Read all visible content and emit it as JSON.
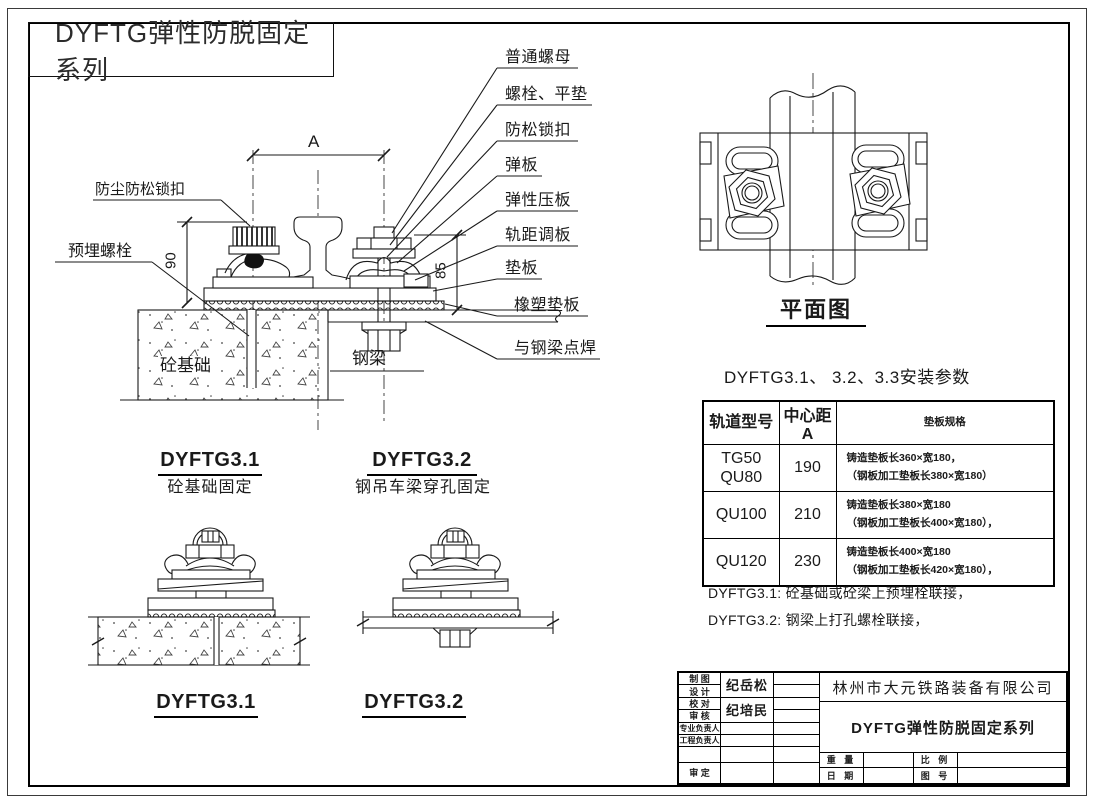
{
  "colors": {
    "ink": "#1a1a1a",
    "paper": "#ffffff"
  },
  "sheet_title": "DYFTG弹性防脱固定系列",
  "main_view": {
    "callouts": [
      "普通螺母",
      "螺栓、平垫",
      "防松锁扣",
      "弹板",
      "弹性压板",
      "轨距调板",
      "垫板",
      "橡塑垫板",
      "与钢梁点焊"
    ],
    "label_dust_lock": "防尘防松锁扣",
    "label_embed_bolt": "预埋螺栓",
    "label_concrete": "砼基础",
    "label_steel_beam": "钢梁",
    "dim_a": "A",
    "dim_height_left": "90",
    "dim_height_right": "85"
  },
  "plan_view": {
    "title": "平面图"
  },
  "variants": {
    "v31": {
      "code": "DYFTG3.1",
      "subtitle": "砼基础固定",
      "bottom_label": "DYFTG3.1"
    },
    "v32": {
      "code": "DYFTG3.2",
      "subtitle": "钢吊车梁穿孔固定",
      "bottom_label": "DYFTG3.2"
    }
  },
  "params_table": {
    "title": "DYFTG3.1、 3.2、3.3安装参数",
    "headers": [
      "轨道型号",
      "中心距 A",
      "垫板规格"
    ],
    "rows": [
      {
        "model1": "TG50",
        "model2": "QU80",
        "center_a": "190",
        "spec1": "铸造垫板长360×宽180，",
        "spec2": "（钢板加工垫板长380×宽180）"
      },
      {
        "model1": "QU100",
        "model2": "",
        "center_a": "210",
        "spec1": "铸造垫板长380×宽180",
        "spec2": "（钢板加工垫板长400×宽180），"
      },
      {
        "model1": "QU120",
        "model2": "",
        "center_a": "230",
        "spec1": "铸造垫板长400×宽180",
        "spec2": "（钢板加工垫板长420×宽180），"
      }
    ]
  },
  "notes": [
    "DYFTG3.1: 砼基础或砼梁上预埋栓联接，",
    "DYFTG3.2: 钢梁上打孔螺栓联接，"
  ],
  "title_block": {
    "row_draw": "制 图",
    "row_design": "设 计",
    "row_check": "校 对",
    "row_audit": "审 核",
    "row_discipline_lead": "专业负责人",
    "row_project_lead": "工程负责人",
    "row_approve": "审 定",
    "designer_name": "纪岳松",
    "auditor_name": "纪培民",
    "company": "林州市大元铁路装备有限公司",
    "product_title": "DYFTG弹性防脱固定系列",
    "field_weight": "重 量",
    "field_scale": "比 例",
    "field_date": "日 期",
    "field_drawing_no": "图 号"
  }
}
